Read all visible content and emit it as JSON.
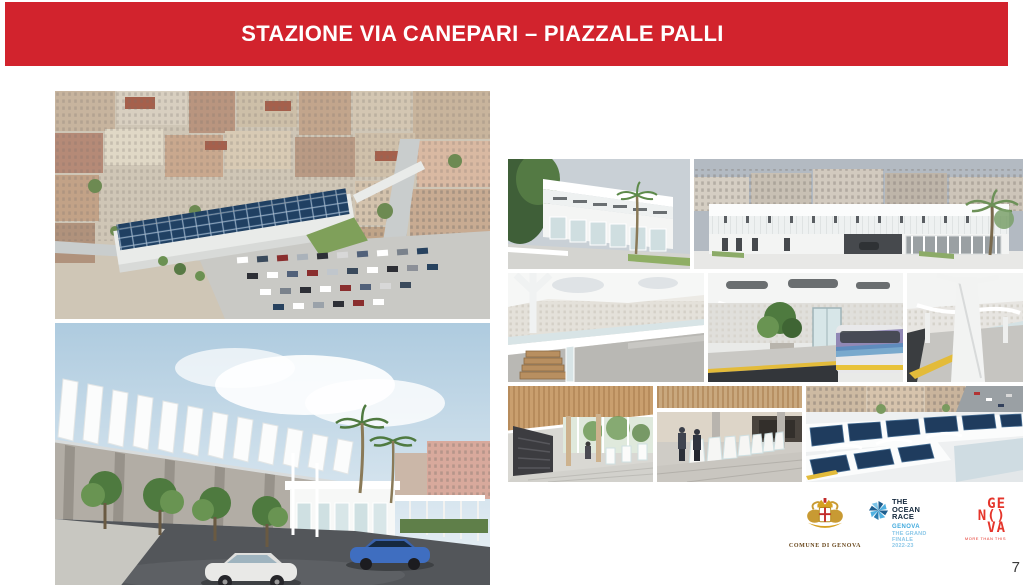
{
  "slide": {
    "title": "STAZIONE VIA CANEPARI – PIAZZALE PALLI",
    "header_color": "#D2232D",
    "background_color": "#FFFFFF"
  },
  "images": {
    "aerial": {
      "label": "aerial-city-view-of-station-with-solar-roof-and-parking"
    },
    "street": {
      "label": "street-level-view-of-station-entrance-with-canopy-trees-and-cars"
    },
    "facade_corner": {
      "label": "white-station-corner-facade-with-palm-tree"
    },
    "elevation": {
      "label": "long-station-elevation-with-apartment-buildings-behind"
    },
    "concourse": {
      "label": "open-concourse-under-white-canopy-with-stairs"
    },
    "platform_tram": {
      "label": "platform-with-tree-glass-lift-and-passing-train"
    },
    "platform_canopy": {
      "label": "platform-columns-and-canopy-with-tactile-strip"
    },
    "hall_wood": {
      "label": "entrance-hall-with-wood-slat-ceiling-and-escalator"
    },
    "turnstiles": {
      "label": "ticket-gate-line-with-people"
    },
    "solar_roof": {
      "label": "aerial-view-of-photovoltaic-roof-over-platforms"
    }
  },
  "footer": {
    "logos": [
      {
        "id": "comune-di-genova",
        "caption": "COMUNE DI GENOVA"
      },
      {
        "id": "the-ocean-race",
        "name_lines": [
          "THE",
          "OCEAN",
          "RACE"
        ],
        "sub_lines": [
          "GENOVA",
          "THE GRAND FINALE",
          "2022-23"
        ],
        "navy": "#14283C",
        "blue": "#3FA9DD",
        "light_blue": "#8CC8E8"
      },
      {
        "id": "genova-more-than-this",
        "name_lines": [
          "GE",
          "N()",
          "VA"
        ],
        "tagline": "MORE THAN THIS",
        "red": "#E5352B"
      }
    ],
    "page_number": "7"
  }
}
